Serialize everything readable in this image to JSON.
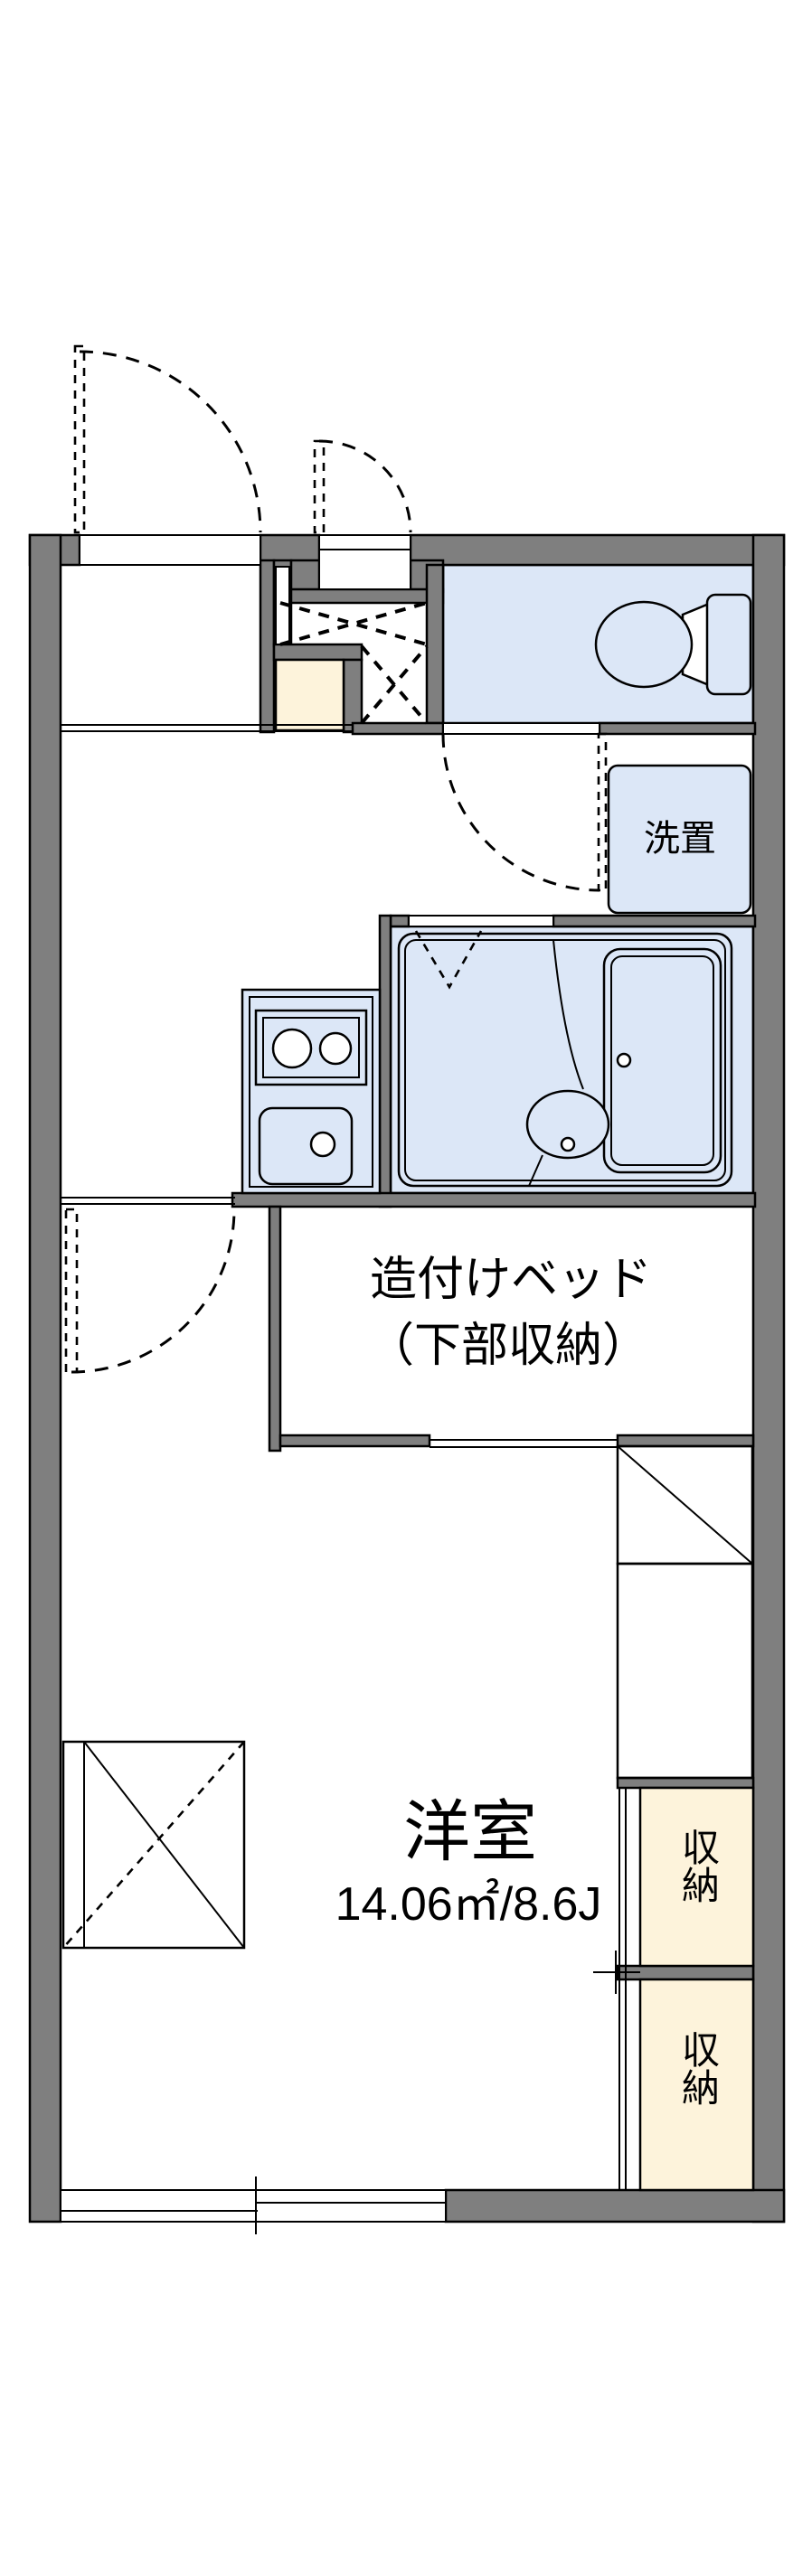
{
  "plan": {
    "rooms": {
      "western_room": {
        "label": "洋室",
        "area_label": "14.06㎡/8.6J"
      },
      "built_in_bed": {
        "label_line1": "造付けベッド",
        "label_line2": "（下部収納）"
      },
      "washer_space": {
        "label": "洗置"
      },
      "closet_upper": {
        "label": "収納"
      },
      "closet_lower": {
        "label": "収納"
      }
    },
    "colors": {
      "wall": "#7f7f7f",
      "water_fixture": "#dce7f7",
      "closet_fill": "#fdf3db",
      "line": "#000000",
      "background": "#ffffff"
    }
  }
}
